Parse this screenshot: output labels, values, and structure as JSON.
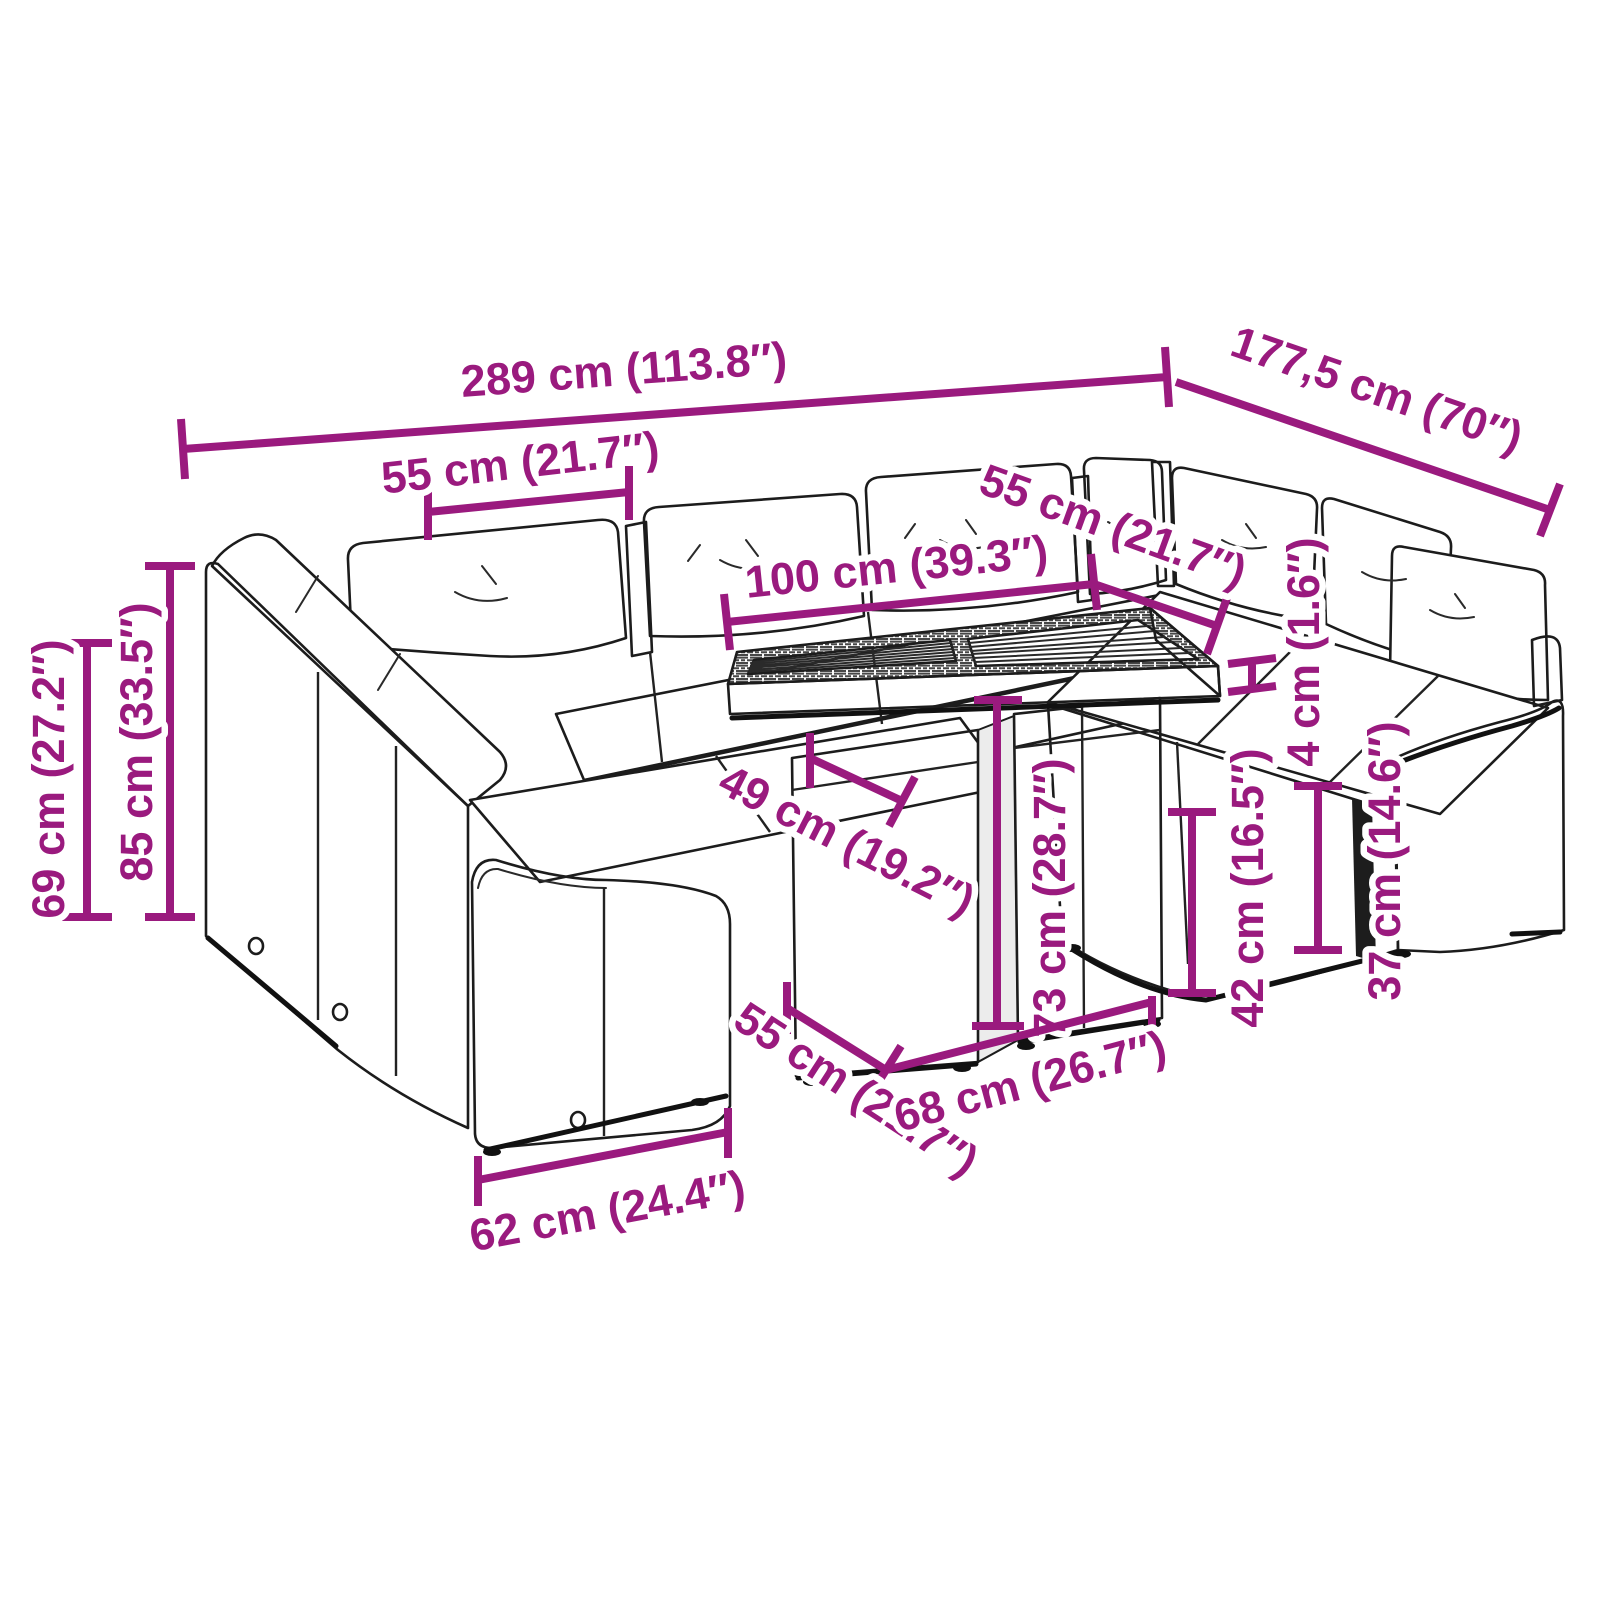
{
  "style": {
    "accent_color": "#9A1A7E",
    "ink_color": "#1c1c1c",
    "background_color": "#ffffff"
  },
  "diagram": {
    "kind": "furniture-dimension-diagram",
    "subject": "garden sofa set with cushions and slatted table"
  },
  "dims": {
    "d289": "289 cm (113.8″)",
    "d177": "177,5 cm (70″)",
    "d55_back": "55 cm (21.7″)",
    "d100": "100 cm (39.3″)",
    "d55_right": "55 cm (21.7″)",
    "d49": "49 cm (19.2″)",
    "d73": "73 cm (28.7″)",
    "d4": "4 cm (1.6″)",
    "d42": "42 cm (16.5″)",
    "d37": "37 cm (14.6″)",
    "d55_seat": "55 cm (21.7″)",
    "d68": "68 cm (26.7″)",
    "d62": "62 cm (24.4″)",
    "d69": "69 cm (27.2″)",
    "d85": "85 cm (33.5″)"
  }
}
